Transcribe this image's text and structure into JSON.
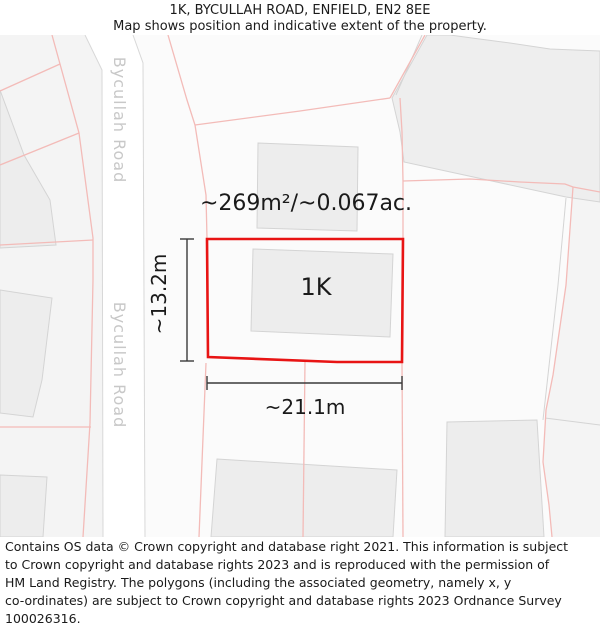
{
  "header": {
    "title": "1K, BYCULLAH ROAD, ENFIELD, EN2 8EE",
    "subtitle": "Map shows position and indicative extent of the property."
  },
  "map": {
    "road_label": "Bycullah Road",
    "plot_label": "1K",
    "area_label": "~269m²/~0.067ac.",
    "width_label": "~21.1m",
    "height_label": "~13.2m",
    "colors": {
      "property_outline": "#e81414",
      "parcel_line": "#f3bbb8",
      "road_border": "#d8d8d8",
      "building_fill": "#ededed",
      "building_stroke": "#d4d4d4",
      "parcel_fill": "#eeeeee",
      "tint_fill": "#f4f4f4",
      "base_fill": "#fbfbfb",
      "road_label_color": "#c8c8c8",
      "dimension_color": "#3a3a3a",
      "label_color": "#1a1a1a"
    }
  },
  "footer": {
    "lines": [
      "Contains OS data © Crown copyright and database right 2021. This information is subject",
      "to Crown copyright and database rights 2023 and is reproduced with the permission of",
      "HM Land Registry. The polygons (including the associated geometry, namely x, y",
      "co-ordinates) are subject to Crown copyright and database rights 2023 Ordnance Survey",
      "100026316."
    ]
  }
}
